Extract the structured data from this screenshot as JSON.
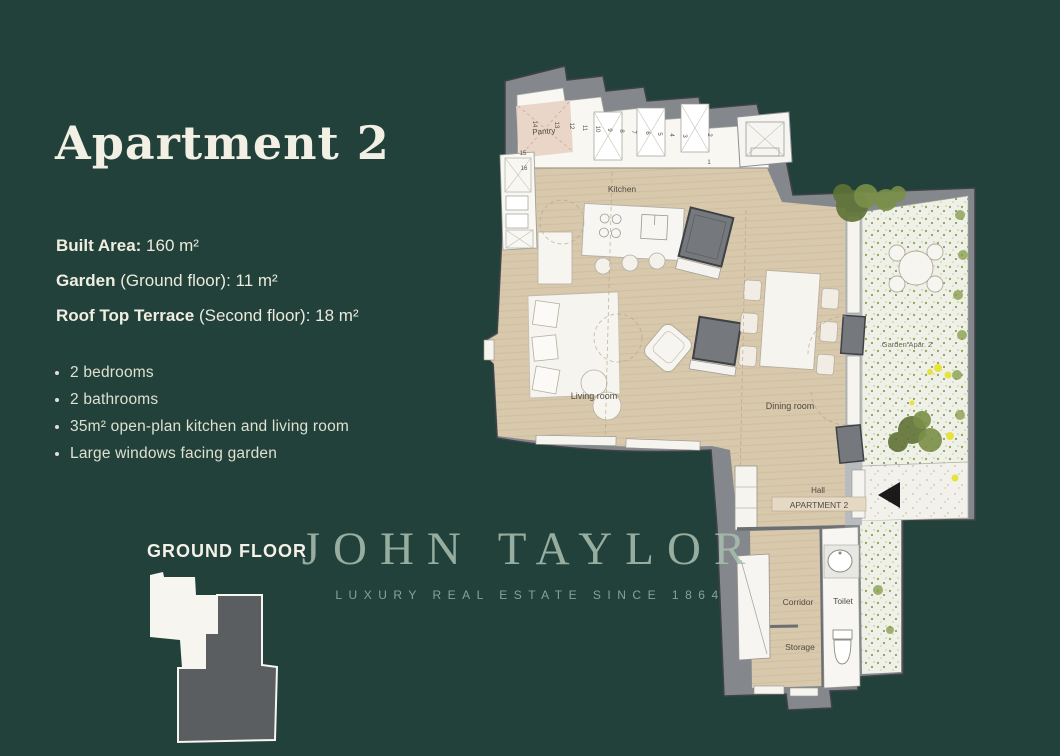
{
  "header": {
    "title": "Apartment 2"
  },
  "specs": [
    {
      "label": "Built Area:",
      "rest": " 160 m²"
    },
    {
      "label": "Garden",
      "rest": " (Ground floor): 11 m²"
    },
    {
      "label": "Roof Top Terrace",
      "rest": " (Second floor): 18 m²"
    }
  ],
  "features": [
    "2 bedrooms",
    "2 bathrooms",
    "35m² open-plan kitchen and living room",
    "Large windows facing garden"
  ],
  "floor_plan": {
    "floor_label": "GROUND FLOOR",
    "apartment_box_label": "APARTMENT 2",
    "rooms": {
      "pantry": "Pantry",
      "kitchen": "Kitchen",
      "living": "Living room",
      "dining": "Dining room",
      "garden": "Garden Apar. 2",
      "hall": "Hall",
      "corridor": "Corridor",
      "toilet": "Toilet",
      "storage": "Storage"
    },
    "cabinet_numbers": [
      "1",
      "2",
      "3",
      "4",
      "5",
      "6",
      "7",
      "8",
      "9",
      "10",
      "11",
      "12",
      "13",
      "14",
      "15",
      "16"
    ]
  },
  "brand": {
    "name": "JOHN TAYLOR",
    "tagline": "LUXURY REAL ESTATE SINCE 1864"
  },
  "colors": {
    "background": "#22413a",
    "heading_text": "#f2efe5",
    "body_text": "#dee0d1",
    "watermark_sage": "#a6bcae",
    "plan_floor_beige": "#d8c8ac",
    "plan_wall_gray": "#84888c",
    "garden_green": "#5f7336",
    "flower_yellow": "#e8e23c",
    "entrance_arrow": "#1a1a1a",
    "minimap_highlight": "#5a5e60"
  }
}
